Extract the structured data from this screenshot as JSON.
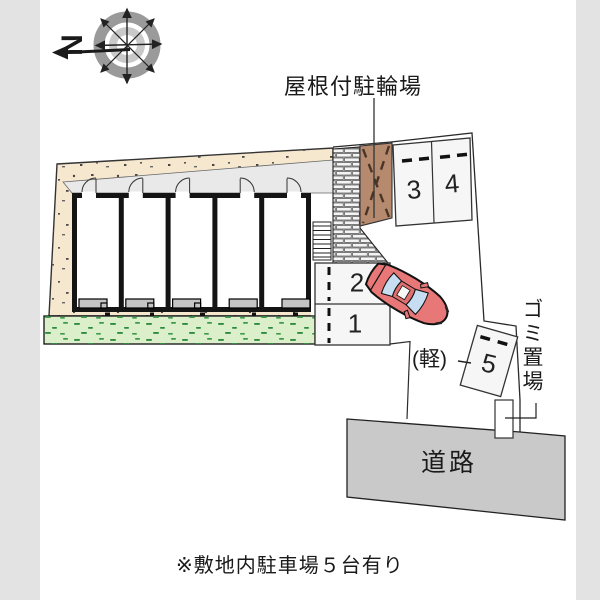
{
  "compass": {
    "north_label": "N"
  },
  "annotations": {
    "bike_parking_label": "屋根付駐輪場",
    "garbage_label": "ゴミ置場",
    "kei_label": "(軽)",
    "road_label": "道路",
    "caption": "※敷地内駐車場５台有り"
  },
  "stalls": {
    "stall1": "1",
    "stall2": "2",
    "stall3": "3",
    "stall4": "4",
    "stall5": "5"
  },
  "colors": {
    "ground_beige": "#f6e7cf",
    "grass_green": "#dcefcb",
    "bike_roof_brown": "#b58a6f",
    "car_red": "#e87878",
    "glass_blue": "#c7def2",
    "road_gray": "#c9c9c9",
    "page_margin_gray": "#e3e3e3",
    "brick_gray": "#cfcfcf",
    "corridor_gray": "#e9e9e9"
  }
}
